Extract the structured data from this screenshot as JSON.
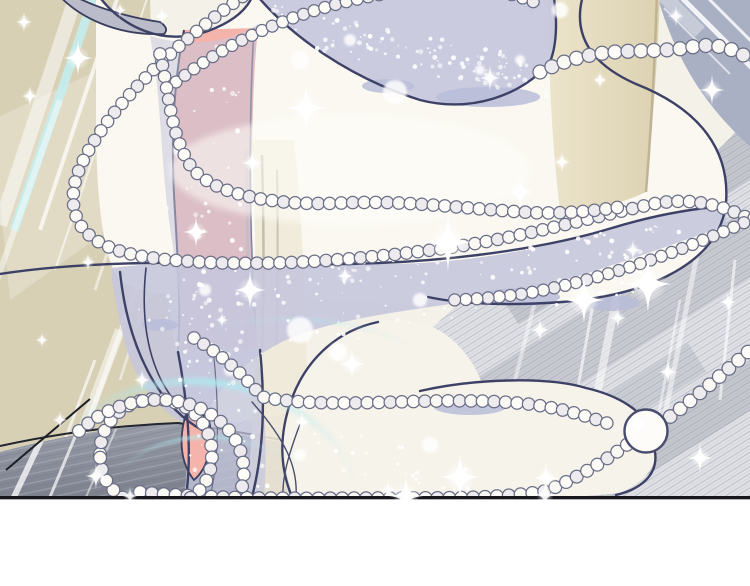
{
  "scene": {
    "type": "comic-panel-illustration",
    "description": "Manhwa-style panel: a sparkling translucent lavender ribbon of fabric swirls in an S-shape, wound with strands of small pearls; a pink leg and heel show behind the fabric; khaki wall with diagonal light beams on the left, pencil-hatched gray floor on the right, blue-gray corner top-right, tan pillar top-center; a large pearl rests bottom-right; black panel border line with white gutter below.",
    "elements": [
      "khaki-wall",
      "light-beams",
      "cyan-light-beam",
      "gray-crescent",
      "white-fabric-dome",
      "lavender-fabric-swath",
      "lavender-fabric-band",
      "lavender-fabric-tail",
      "pink-leg",
      "pink-heel",
      "cream-fold",
      "tan-pillar",
      "blue-gray-corner",
      "hatched-floor",
      "dark-floor-wedge",
      "pearl-strands",
      "pearl-loop",
      "large-pearl",
      "cyan-glow-arcs",
      "sparkles",
      "snow-speckles",
      "panel-border-line",
      "white-gutter"
    ]
  },
  "palette": {
    "bg": "#f4f1e8",
    "wall": "#d7d0b5",
    "wallLight": "#ebe6d6",
    "beamWhite": "#ffffff",
    "beamCyan": "#c4eff2",
    "crescent": "#babcca",
    "pillarLight": "#ece4cb",
    "pillarShade": "#dcd2b2",
    "pillarEdge": "#bfb394",
    "cornerBlue": "#a9b0c3",
    "floorBase": "#e0e1e6",
    "floorHatch": "#a9adb6",
    "floorBand": "#9da1ac",
    "wedgeTop": "#9296a1",
    "wedgeBottom": "#7b808c",
    "wedgeLine": "#b7bac2",
    "fabricWhite": "#faf8f1",
    "fabricWhite2": "#f6f3ea",
    "lavender": "#c6c7dd",
    "lavenderDeep": "#b6b8d2",
    "shadowLavender": "#b9bdd8",
    "navy": "#3d4166",
    "navySoft": "#5a5e7c",
    "pearlFill": "#fdfcf8",
    "pearlShade": "#edebee",
    "pearlStroke": "#696d86",
    "pink": "#f4b4ab",
    "pinkLine": "#3a3e5f",
    "cream": "#efe9d8",
    "grayStrip": "#b5b2a6",
    "cyanGlow": "#aeeaf0",
    "sparkle": "#ffffff",
    "border": "#17171c",
    "gutter": "#ffffff"
  },
  "effects": {
    "pearl_radius": 6.2,
    "large_pearl_radius": 21.5,
    "sparkle_count": 37,
    "speckle_clusters": 6
  }
}
